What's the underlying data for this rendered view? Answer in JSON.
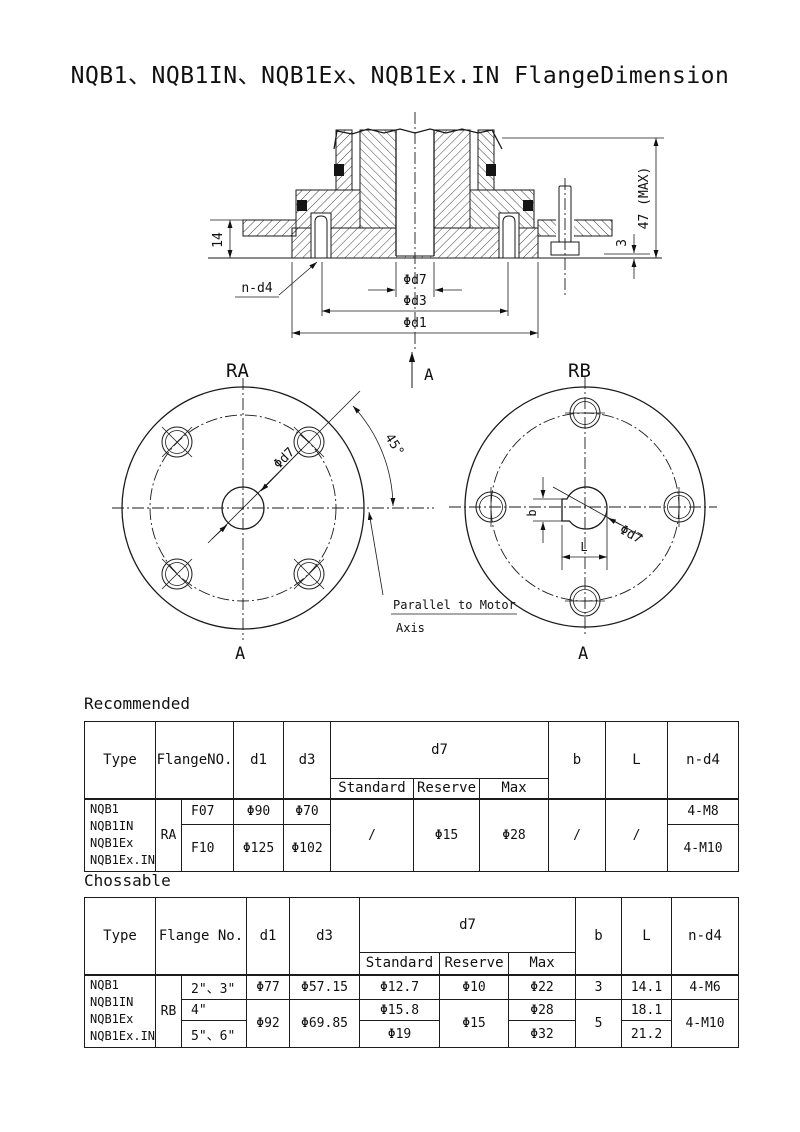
{
  "page": {
    "title": "NQB1、NQB1IN、NQB1Ex、NQB1Ex.IN FlangeDimension"
  },
  "drawing": {
    "dim_14": "14",
    "dim_3": "3",
    "dim_47max": "47 (MAX)",
    "label_n_d4": "n-d4",
    "dim_d7": "Φd7",
    "dim_d3": "Φd3",
    "dim_d1": "Φd1",
    "section_arrow_label": "A",
    "note_line1": "Parallel to Motor",
    "note_line2": "Axis",
    "ra": {
      "title": "RA",
      "bottom_label": "A",
      "angle": "45°",
      "d7": "Φd7"
    },
    "rb": {
      "title": "RB",
      "bottom_label": "A",
      "d7": "Φd7",
      "dim_b": "b",
      "dim_l": "L"
    }
  },
  "tables": {
    "recommended": {
      "caption": "Recommended",
      "header": {
        "type": "Type",
        "flange_no": "FlangeNO.",
        "d1": "d1",
        "d3": "d3",
        "d7": "d7",
        "standard": "Standard",
        "reserve": "Reserve",
        "max": "Max",
        "b": "b",
        "l": "L",
        "n_d4": "n-d4"
      },
      "types": [
        "NQB1",
        "NQB1IN",
        "NQB1Ex",
        "NQB1Ex.IN"
      ],
      "group": "RA",
      "rows": [
        {
          "flange": "F07",
          "d1": "Φ90",
          "d3": "Φ70",
          "n_d4": "4-M8"
        },
        {
          "flange": "F10",
          "d1": "Φ125",
          "d3": "Φ102",
          "n_d4": "4-M10"
        }
      ],
      "shared": {
        "standard": "/",
        "reserve": "Φ15",
        "max": "Φ28",
        "b": "/",
        "l": "/"
      }
    },
    "chossable": {
      "caption": "Chossable",
      "header": {
        "type": "Type",
        "flange_no": "Flange No.",
        "d1": "d1",
        "d3": "d3",
        "d7": "d7",
        "standard": "Standard",
        "reserve": "Reserve",
        "max": "Max",
        "b": "b",
        "l": "L",
        "n_d4": "n-d4"
      },
      "types": [
        "NQB1",
        "NQB1IN",
        "NQB1Ex",
        "NQB1Ex.IN"
      ],
      "group": "RB",
      "row1": {
        "flange": "2\"、3\"",
        "d1": "Φ77",
        "d3": "Φ57.15",
        "standard": "Φ12.7",
        "reserve": "Φ10",
        "max": "Φ22",
        "b": "3",
        "l": "14.1",
        "n_d4": "4-M6"
      },
      "row2": {
        "flange": "4\"",
        "standard": "Φ15.8",
        "max": "Φ28",
        "l": "18.1"
      },
      "row3": {
        "flange": "5\"、6\"",
        "standard": "Φ19",
        "max": "Φ32",
        "l": "21.2"
      },
      "rows23": {
        "d1": "Φ92",
        "d3": "Φ69.85",
        "reserve": "Φ15",
        "b": "5",
        "n_d4": "4-M10"
      }
    }
  }
}
